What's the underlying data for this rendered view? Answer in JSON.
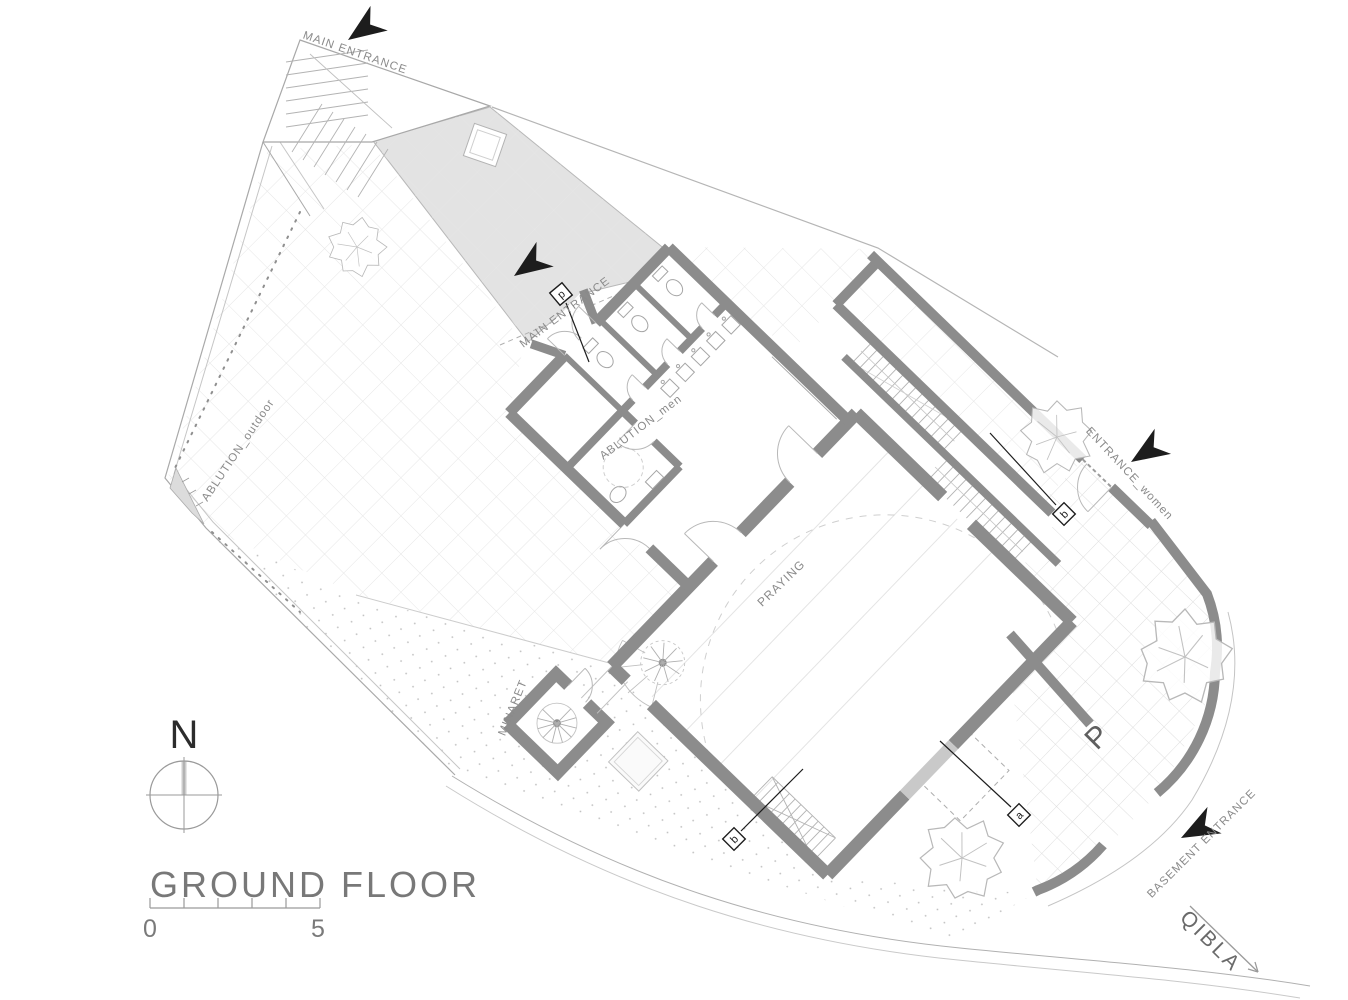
{
  "drawing": {
    "title": "GROUND FLOOR",
    "compass_label": "N",
    "scale": {
      "start_label": "0",
      "end_label": "5"
    },
    "qibla_label": "QIBLA",
    "parking_label": "P"
  },
  "rooms": {
    "praying": "PRAYING",
    "ablution_men": "ABLUTION_men",
    "ablution_outdoor": "ABLUTION_outdoor",
    "minaret": "MINARET"
  },
  "entrances": {
    "main_top": "MAIN ENTRANCE",
    "main_inner": "MAIN ENTRANCE",
    "women": "ENTRANCE_women",
    "basement": "BASEMENT ENTRANCE"
  },
  "section_markers": {
    "p": "p",
    "b_upper": "b",
    "b_lower": "b",
    "a": "a"
  },
  "colors": {
    "wall": "#8c8c8c",
    "wall_light": "#c9c9c9",
    "ramp_fill": "#e3e3e3",
    "label": "#8a8a8a",
    "ink": "#1d1d1d"
  }
}
